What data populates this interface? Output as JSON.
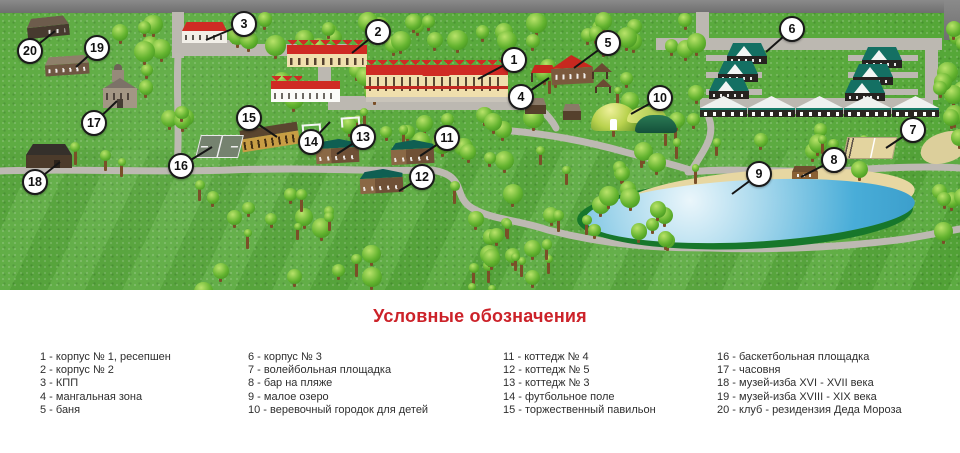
{
  "legend": {
    "title": "Условные обозначения",
    "columns": [
      [
        "1 - корпус № 1, ресепшен",
        "2 - корпус № 2",
        "3 - КПП",
        "4 - мангальная зона",
        "5 - баня"
      ],
      [
        "6 - корпус № 3",
        "7 - волейбольная площадка",
        "8 - бар на пляже",
        "9 - малое озеро",
        "10 - веревочный городок для детей"
      ],
      [
        "11 - коттедж № 4",
        "12 - коттедж № 5",
        "13 - коттедж № 3",
        "14 - футбольное поле",
        "15 - торжественный павильон"
      ],
      [
        "16 - баскетбольная площадка",
        "17 - часовня",
        "18 - музей-изба XVI - XVII века",
        "19 - музей-изба XVIII - XIX века",
        "20 - клуб - резидензия Деда Мороза"
      ]
    ]
  },
  "map": {
    "markers": [
      {
        "n": "1",
        "label": "корпус № 1, ресепшен",
        "x": 514,
        "y": 60,
        "tx": 478,
        "ty": 79
      },
      {
        "n": "2",
        "label": "корпус № 2",
        "x": 378,
        "y": 32,
        "tx": 352,
        "ty": 53
      },
      {
        "n": "3",
        "label": "КПП",
        "x": 244,
        "y": 24,
        "tx": 206,
        "ty": 40
      },
      {
        "n": "4",
        "label": "мангальная зона",
        "x": 521,
        "y": 97,
        "tx": 549,
        "ty": 78
      },
      {
        "n": "5",
        "label": "баня",
        "x": 608,
        "y": 43,
        "tx": 574,
        "ty": 68
      },
      {
        "n": "6",
        "label": "корпус № 3",
        "x": 792,
        "y": 29,
        "tx": 766,
        "ty": 52
      },
      {
        "n": "7",
        "label": "волейбольная площадка",
        "x": 913,
        "y": 130,
        "tx": 886,
        "ty": 148
      },
      {
        "n": "8",
        "label": "бар на пляже",
        "x": 834,
        "y": 160,
        "tx": 801,
        "ty": 177
      },
      {
        "n": "9",
        "label": "малое озеро",
        "x": 759,
        "y": 174,
        "tx": 732,
        "ty": 194
      },
      {
        "n": "10",
        "label": "веревочный городок для детей",
        "x": 660,
        "y": 98,
        "tx": 631,
        "ty": 114
      },
      {
        "n": "11",
        "label": "коттедж № 4",
        "x": 447,
        "y": 138,
        "tx": 420,
        "ty": 156
      },
      {
        "n": "12",
        "label": "коттедж № 5",
        "x": 422,
        "y": 177,
        "tx": 399,
        "ty": 191
      },
      {
        "n": "13",
        "label": "коттедж № 3",
        "x": 363,
        "y": 137,
        "tx": 337,
        "ty": 154
      },
      {
        "n": "14",
        "label": "футбольное поле",
        "x": 311,
        "y": 142,
        "tx": 330,
        "ty": 122
      },
      {
        "n": "15",
        "label": "торжественный павильон",
        "x": 249,
        "y": 118,
        "tx": 277,
        "ty": 137
      },
      {
        "n": "16",
        "label": "баскетбольная площадка",
        "x": 181,
        "y": 166,
        "tx": 212,
        "ty": 147
      },
      {
        "n": "17",
        "label": "часовня",
        "x": 94,
        "y": 123,
        "tx": 117,
        "ty": 101
      },
      {
        "n": "18",
        "label": "музей-изба XVI - XVII века",
        "x": 35,
        "y": 182,
        "tx": 60,
        "ty": 162
      },
      {
        "n": "19",
        "label": "музей-изба XVIII - XIX века",
        "x": 97,
        "y": 48,
        "tx": 76,
        "ty": 67
      },
      {
        "n": "20",
        "label": "клуб - резидензия Деда Мороза",
        "x": 30,
        "y": 51,
        "tx": 55,
        "ty": 31
      }
    ]
  },
  "colors": {
    "accent": "#cc2229",
    "grass": "#55a738",
    "road": "#bcb8b1",
    "road_dark": "#787878",
    "lake": "#45aad5",
    "sand": "#e7d7a2",
    "roof_red": "#cf2b24",
    "roof_teal": "#157a67"
  }
}
